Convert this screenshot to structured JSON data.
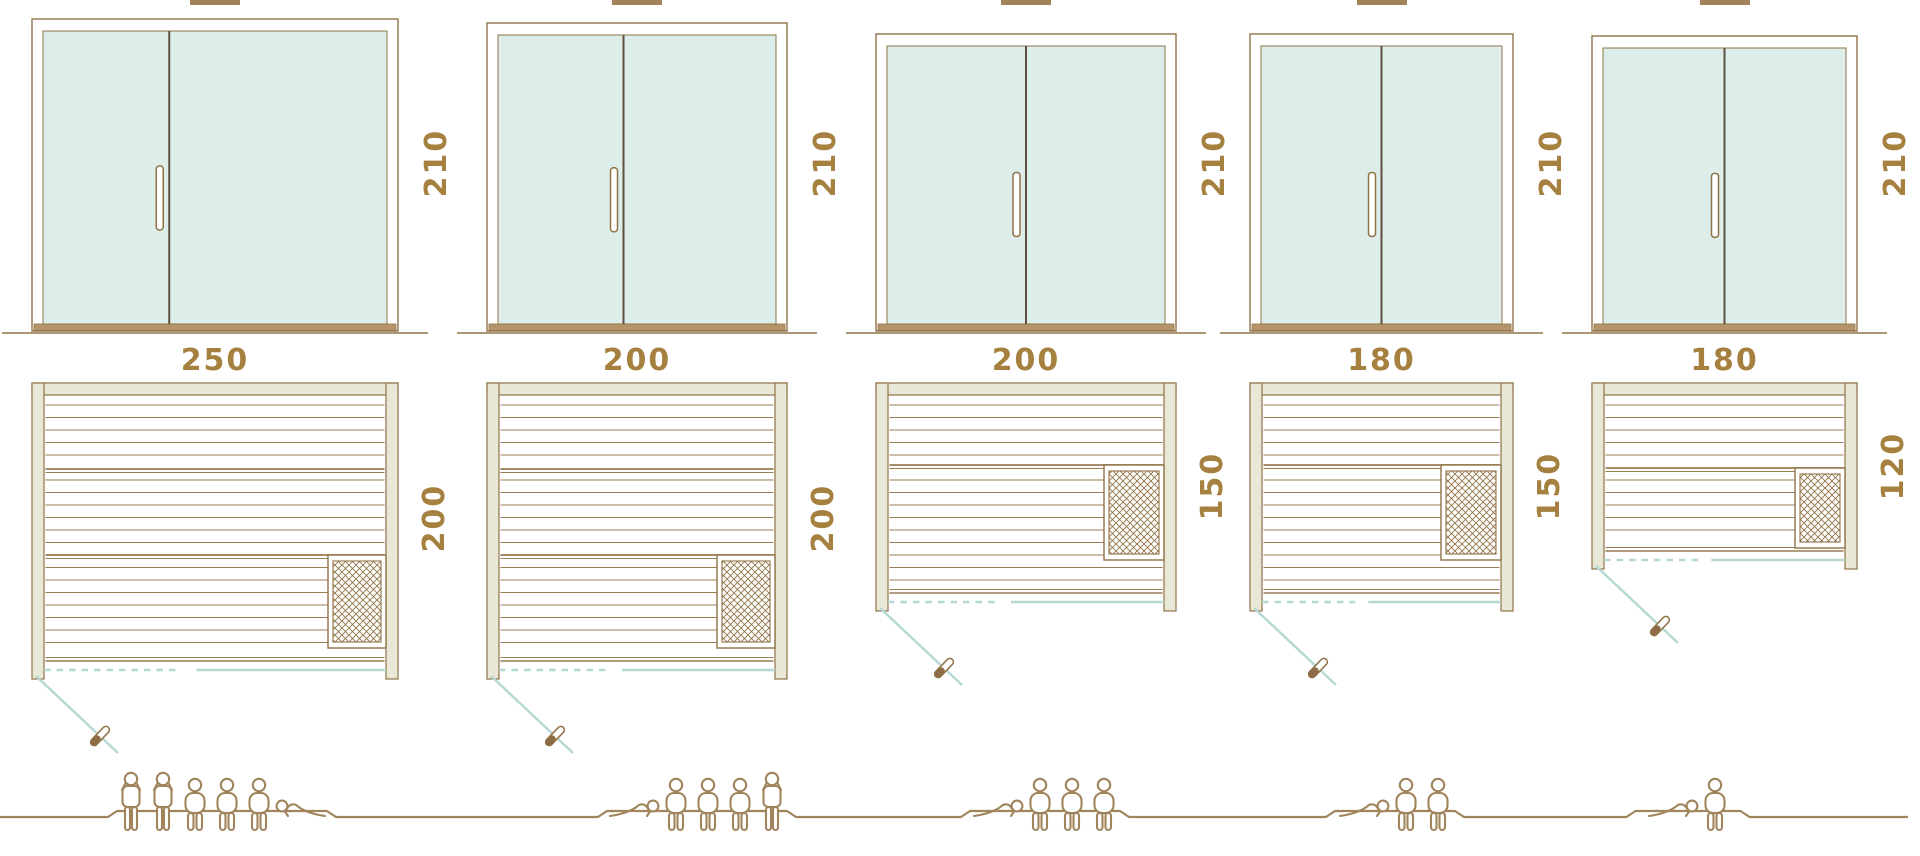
{
  "title": "Sauna size comparison diagram",
  "colors": {
    "line_brown": "#8f7347",
    "bench_brown": "#9a7c52",
    "dark_brown": "#5e4f3e",
    "wall_fill": "#e9e7d6",
    "glass_fill": "#ddeeea",
    "teal": "#b5d8d2",
    "label": "#a5803e",
    "sill": "#b6946a",
    "people": "#a0855c",
    "handle_fill": "#8f6b46",
    "top_bar": "#a3835a"
  },
  "diagram": {
    "door_height_unit_note": "",
    "variants": [
      {
        "id": "sauna-250x200",
        "width_label": "250",
        "depth_label": "200",
        "height_label": "210",
        "capacity": {
          "standing": 2,
          "sitting": 3,
          "lying": 1,
          "total": 6
        },
        "figures": [
          "standing",
          "standing",
          "sitting",
          "sitting",
          "sitting",
          "lying_right"
        ],
        "layout": {
          "x": 32,
          "w": 366,
          "door_top": 18,
          "divider_frac": 0.375,
          "depth": 287,
          "heater": {
            "y": 172,
            "h": 93,
            "w": 58
          },
          "plateau": {
            "cx": 222,
            "w": 210
          }
        }
      },
      {
        "id": "sauna-200x200",
        "width_label": "200",
        "depth_label": "200",
        "height_label": "210",
        "capacity": {
          "standing": 1,
          "sitting": 3,
          "lying": 1,
          "total": 5
        },
        "figures": [
          "lying_left",
          "sitting",
          "sitting",
          "sitting",
          "standing"
        ],
        "layout": {
          "x": 487,
          "w": 300,
          "door_top": 22,
          "divider_frac": 0.455,
          "depth": 287,
          "heater": {
            "y": 172,
            "h": 93,
            "w": 58
          },
          "plateau": {
            "cx": 697,
            "w": 180
          }
        }
      },
      {
        "id": "sauna-200x150",
        "width_label": "200",
        "depth_label": "150",
        "height_label": "210",
        "capacity": {
          "standing": 0,
          "sitting": 3,
          "lying": 1,
          "total": 4
        },
        "figures": [
          "lying_left",
          "sitting",
          "sitting",
          "sitting"
        ],
        "layout": {
          "x": 876,
          "w": 300,
          "door_top": 33,
          "divider_frac": 0.5,
          "depth": 219,
          "heater": {
            "y": 82,
            "h": 95,
            "w": 60
          },
          "plateau": {
            "cx": 1045,
            "w": 150
          }
        }
      },
      {
        "id": "sauna-180x150",
        "width_label": "180",
        "depth_label": "150",
        "height_label": "210",
        "capacity": {
          "standing": 0,
          "sitting": 2,
          "lying": 1,
          "total": 3
        },
        "figures": [
          "lying_left",
          "sitting",
          "sitting"
        ],
        "layout": {
          "x": 1250,
          "w": 263,
          "door_top": 33,
          "divider_frac": 0.5,
          "depth": 219,
          "heater": {
            "y": 82,
            "h": 95,
            "w": 60
          },
          "plateau": {
            "cx": 1395,
            "w": 120
          }
        }
      },
      {
        "id": "sauna-180x120",
        "width_label": "180",
        "depth_label": "120",
        "height_label": "210",
        "capacity": {
          "standing": 0,
          "sitting": 1,
          "lying": 1,
          "total": 2
        },
        "figures": [
          "lying_left",
          "sitting"
        ],
        "layout": {
          "x": 1592,
          "w": 265,
          "door_top": 35,
          "divider_frac": 0.5,
          "depth": 177,
          "heater": {
            "y": 85,
            "h": 80,
            "w": 50
          },
          "plateau": {
            "cx": 1688,
            "w": 105
          }
        }
      }
    ]
  }
}
